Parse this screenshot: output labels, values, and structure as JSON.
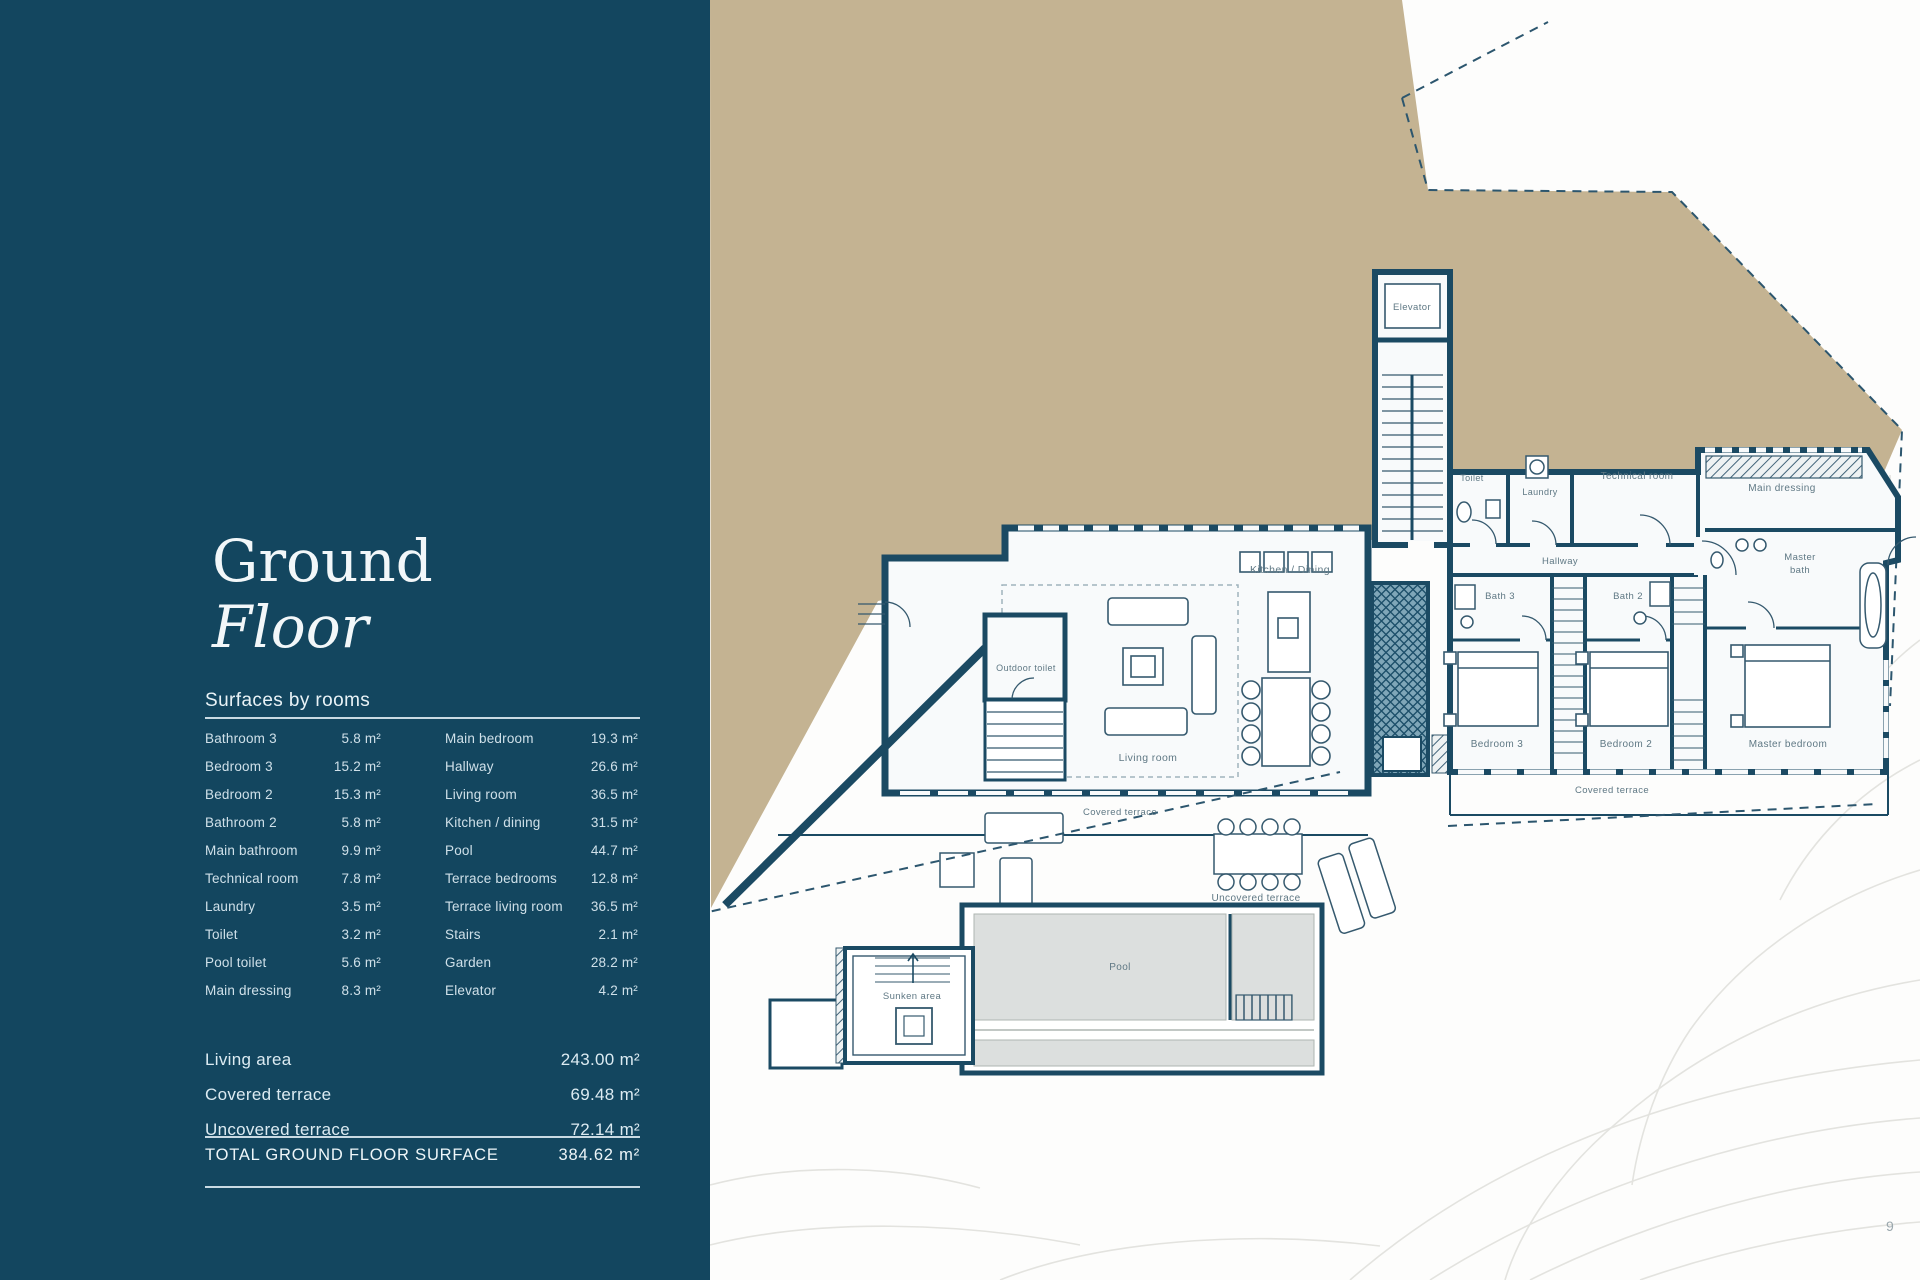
{
  "page": {
    "number": "9"
  },
  "panel": {
    "title_line1": "Ground",
    "title_line2": "Floor",
    "table_heading": "Surfaces by rooms",
    "rooms_left": [
      {
        "name": "Bathroom 3",
        "value": "5.8 m²"
      },
      {
        "name": "Bedroom 3",
        "value": "15.2 m²"
      },
      {
        "name": "Bedroom 2",
        "value": "15.3 m²"
      },
      {
        "name": "Bathroom 2",
        "value": "5.8 m²"
      },
      {
        "name": "Main bathroom",
        "value": "9.9 m²"
      },
      {
        "name": "Technical room",
        "value": "7.8 m²"
      },
      {
        "name": "Laundry",
        "value": "3.5 m²"
      },
      {
        "name": "Toilet",
        "value": "3.2 m²"
      },
      {
        "name": "Pool toilet",
        "value": "5.6 m²"
      },
      {
        "name": "Main dressing",
        "value": "8.3 m²"
      }
    ],
    "rooms_right": [
      {
        "name": "Main bedroom",
        "value": "19.3 m²"
      },
      {
        "name": "Hallway",
        "value": "26.6 m²"
      },
      {
        "name": "Living room",
        "value": "36.5 m²"
      },
      {
        "name": "Kitchen / dining",
        "value": "31.5 m²"
      },
      {
        "name": "Pool",
        "value": "44.7 m²"
      },
      {
        "name": "Terrace bedrooms",
        "value": "12.8 m²"
      },
      {
        "name": "Terrace living room",
        "value": "36.5 m²"
      },
      {
        "name": "Stairs",
        "value": "2.1 m²"
      },
      {
        "name": "Garden",
        "value": "28.2 m²"
      },
      {
        "name": "Elevator",
        "value": "4.2 m²"
      }
    ],
    "summary": [
      {
        "name": "Living area",
        "value": "243.00 m²"
      },
      {
        "name": "Covered terrace",
        "value": "69.48 m²"
      },
      {
        "name": "Uncovered terrace",
        "value": "72.14 m²"
      }
    ],
    "total": {
      "label": "TOTAL GROUND FLOOR SURFACE",
      "value": "384.62 m²"
    }
  },
  "plan": {
    "elevator": "Elevator",
    "kitchen_dining": "Kitchen / Dining",
    "living_room": "Living room",
    "covered_terrace_left": "Covered terrace",
    "covered_terrace_right": "Covered terrace",
    "uncovered_terrace": "Uncovered terrace",
    "pool": "Pool",
    "sunken_area": "Sunken area",
    "outdoor_toilet": "Outdoor toilet",
    "toilet": "Toilet",
    "laundry": "Laundry",
    "technical_room": "Technical room",
    "main_dressing": "Main dressing",
    "hallway": "Hallway",
    "bath_3": "Bath 3",
    "bath_2": "Bath 2",
    "master_bath_line1": "Master",
    "master_bath_line2": "bath",
    "bedroom_3": "Bedroom 3",
    "bedroom_2": "Bedroom 2",
    "master_bedroom": "Master bedroom"
  },
  "colors": {
    "panel_bg": "#13465f",
    "terrain_beige": "#c4b392",
    "wall_blue": "#1b4a63",
    "plan_label": "#5f7884",
    "pool_water": "#dcdfde"
  }
}
